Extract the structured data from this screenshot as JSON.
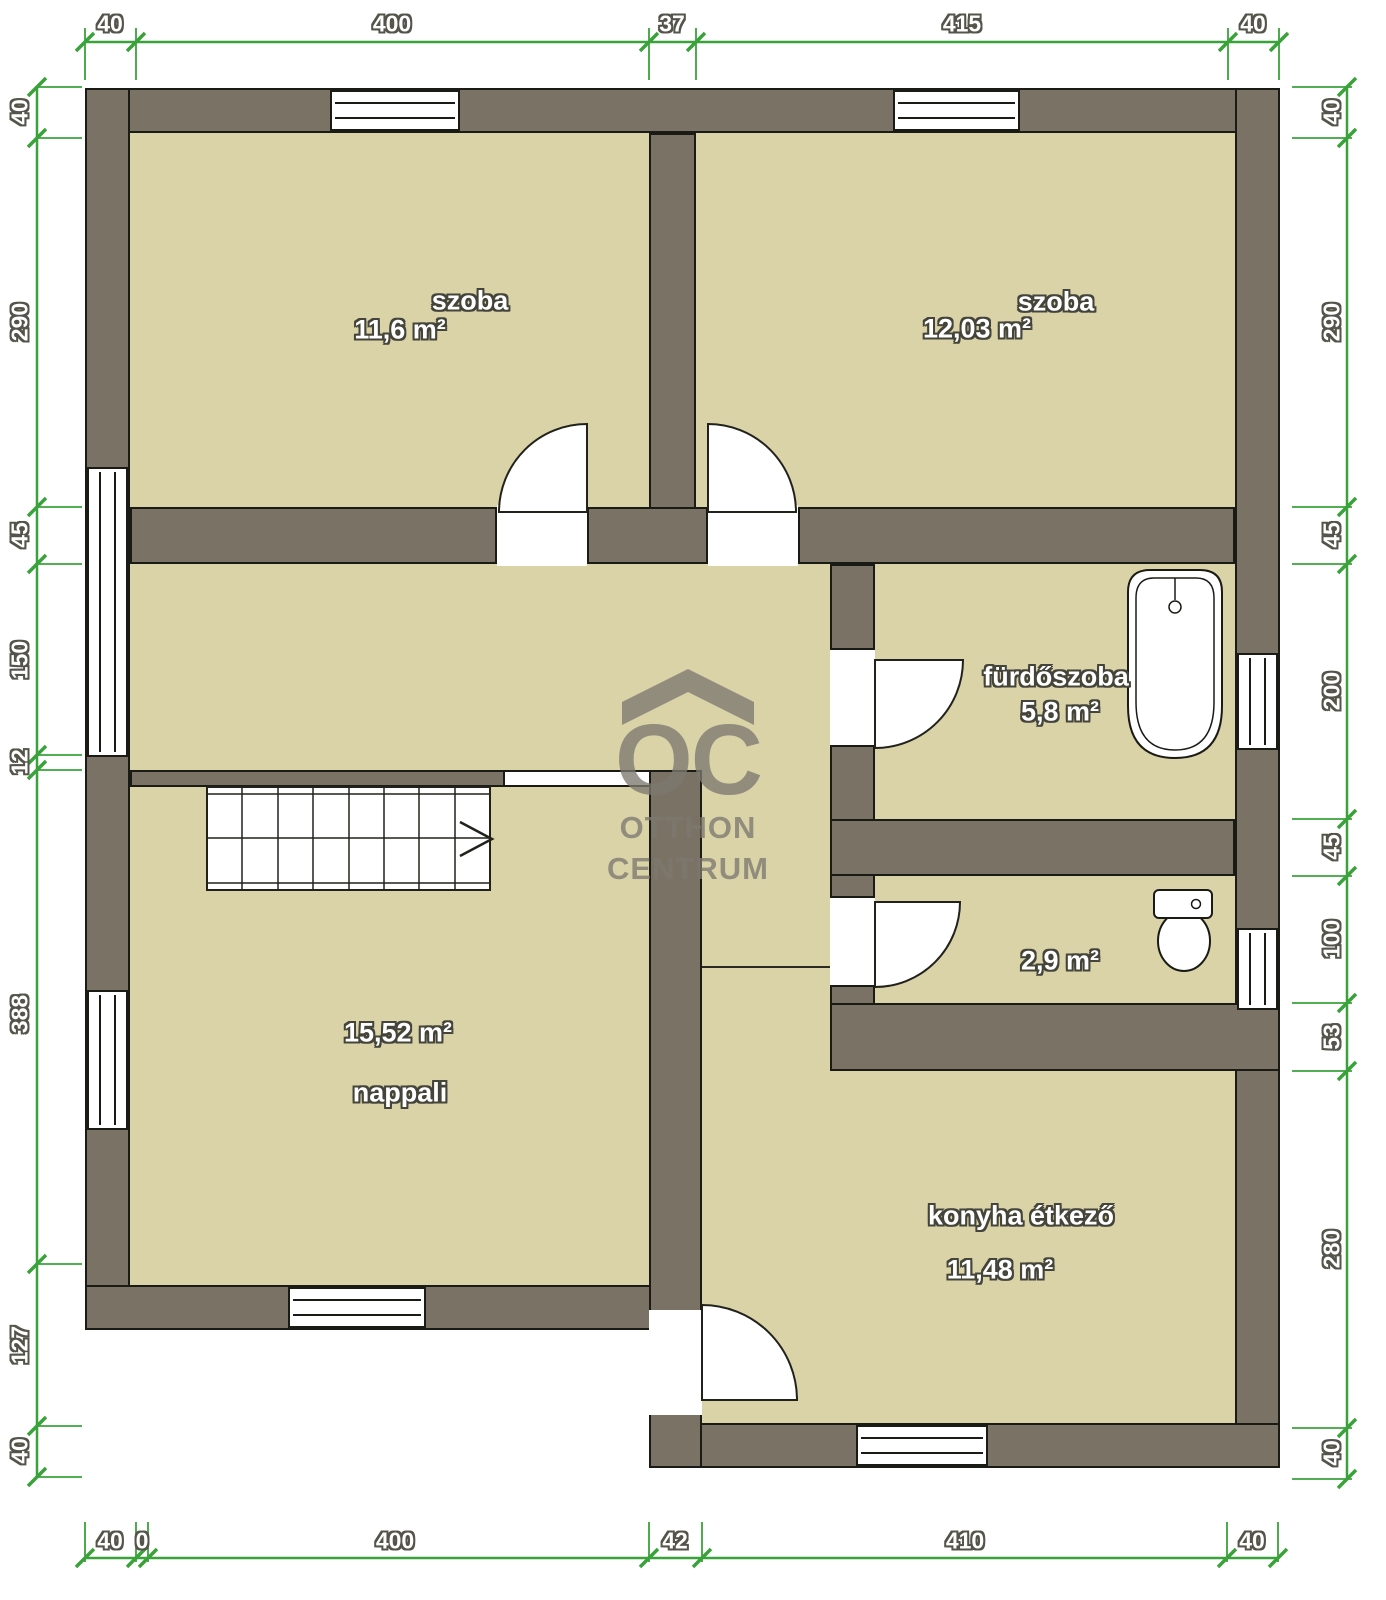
{
  "plan_title": "floor-plan",
  "colors": {
    "wall_fill": "#7b7266",
    "wall_outline": "#1b1b16",
    "room_fill": "#d9d3a7",
    "dimension_green": "#3aa23a",
    "label_text": "#ffffff",
    "watermark_gray": "#8e8b80"
  },
  "rooms": {
    "szoba1": {
      "name": "szoba",
      "area": "11,6 m²"
    },
    "szoba2": {
      "name": "szoba",
      "area": "12,03 m²"
    },
    "furdoszoba": {
      "name": "fürdőszoba",
      "area": "5,8 m²"
    },
    "wc": {
      "area": "2,9 m²"
    },
    "nappali": {
      "name": "nappali",
      "area": "15,52 m²"
    },
    "konyha": {
      "name": "konyha étkező",
      "area": "11,48 m²"
    }
  },
  "dims": {
    "top": [
      "40",
      "400",
      "37",
      "415",
      "40"
    ],
    "bottom": [
      "40",
      "0",
      "400",
      "42",
      "410",
      "40"
    ],
    "left": [
      "40",
      "290",
      "45",
      "150",
      "12",
      "388",
      "127",
      "40"
    ],
    "right": [
      "40",
      "290",
      "45",
      "200",
      "45",
      "100",
      "53",
      "280",
      "40"
    ]
  },
  "watermark": {
    "monogram": "OC",
    "line1": "OTTHON",
    "line2": "CENTRUM"
  }
}
